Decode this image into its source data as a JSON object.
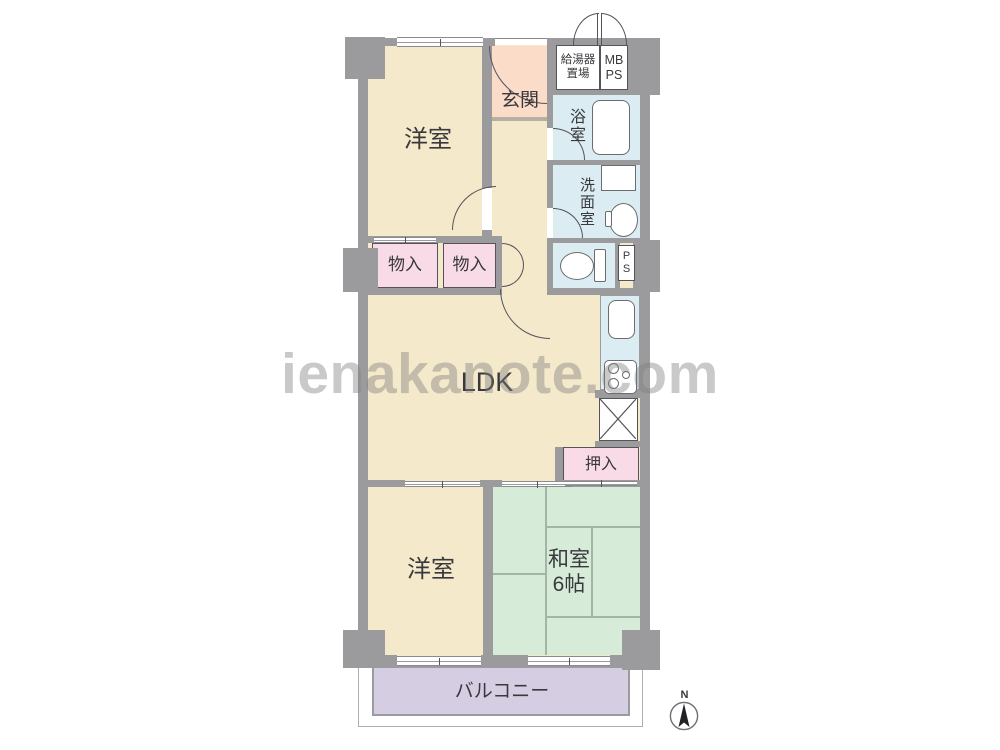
{
  "floorplan": {
    "watermark": "ienakanote.com",
    "compass": {
      "north_label": "N"
    },
    "rooms": {
      "western_room_top": "洋室",
      "entrance": "玄関",
      "water_heater_space": {
        "line1": "給湯器",
        "line2": "置場"
      },
      "meter_box_pipe_space": {
        "line1": "MB",
        "line2": "PS"
      },
      "bathroom": "浴室",
      "washroom": "洗面室",
      "pipe_space": {
        "line1": "P",
        "line2": "S"
      },
      "storage_left": "物入",
      "storage_right": "物入",
      "ldk": "LDK",
      "closet": "押入",
      "western_room_bottom": "洋室",
      "japanese_room": {
        "line1": "和室",
        "line2": "6帖"
      },
      "balcony": "バルコニー"
    },
    "colors": {
      "wall": "#9b9b9e",
      "wall_dark": "#55535a",
      "cream": "#f5e9cb",
      "peach": "#fbdcc8",
      "pink": "#f8dbe7",
      "blue": "#dbedf2",
      "green": "#d7ecd8",
      "lavender": "#d5cee3",
      "tatami_line": "#a3b5a4",
      "label": "#39383d",
      "watermark": "rgba(127,127,127,0.42)"
    }
  }
}
